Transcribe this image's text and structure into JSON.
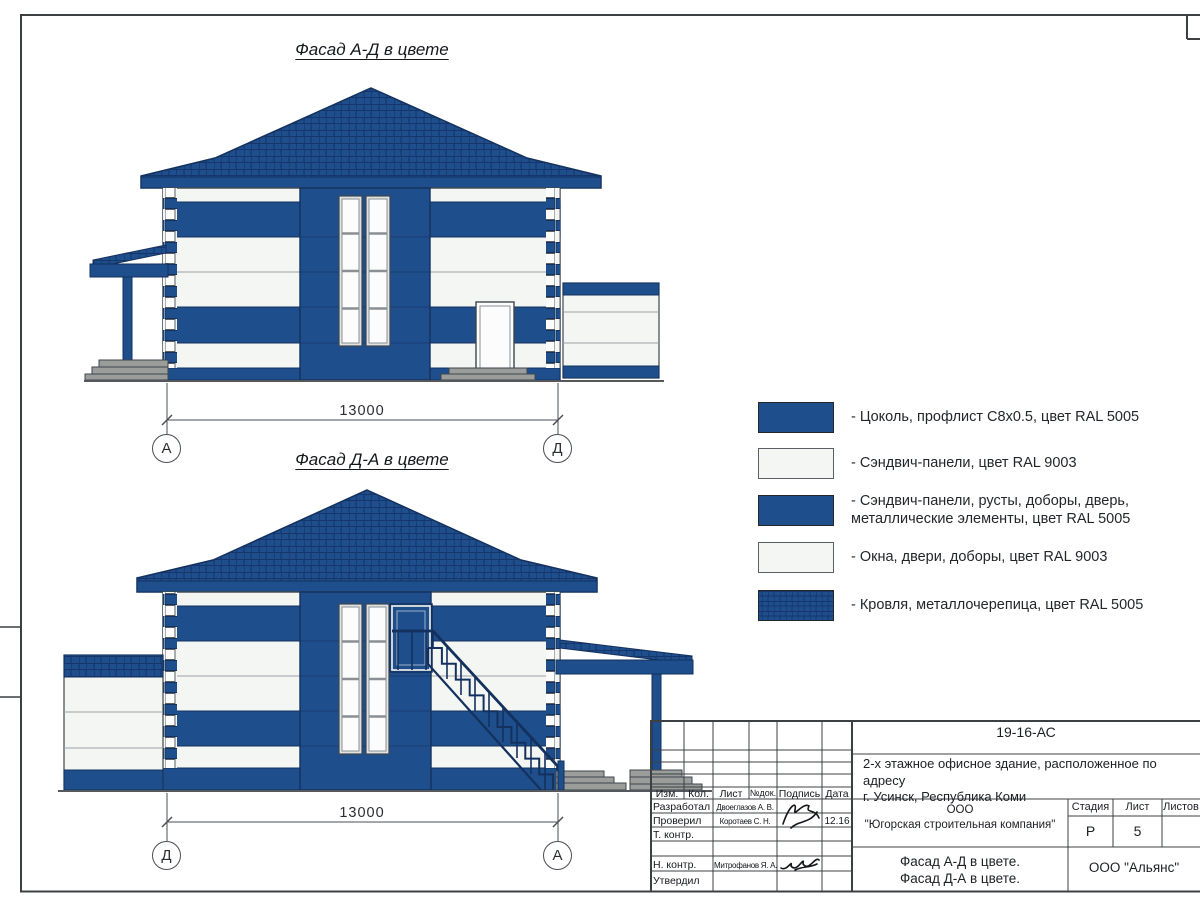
{
  "drawing": {
    "facade1": {
      "title": "Фасад А-Д в цвете",
      "dimension": "13000",
      "axis_left": "А",
      "axis_right": "Д"
    },
    "facade2": {
      "title": "Фасад Д-А в цвете",
      "dimension": "13000",
      "axis_left": "Д",
      "axis_right": "А"
    }
  },
  "legend": {
    "items": [
      {
        "swatch": "blue",
        "label": "- Цоколь, профлист С8х0.5, цвет RAL 5005"
      },
      {
        "swatch": "white",
        "label": "- Сэндвич-панели, цвет RAL 9003"
      },
      {
        "swatch": "blue",
        "label": "- Сэндвич-панели, русты, доборы, дверь,\nметаллические элементы, цвет RAL 5005"
      },
      {
        "swatch": "white",
        "label": "- Окна, двери, доборы, цвет RAL 9003"
      },
      {
        "swatch": "roof",
        "label": "- Кровля, металлочерепица, цвет RAL 5005"
      }
    ]
  },
  "title_block": {
    "doc_number": "19-16-АС",
    "project_title": "2-х этажное офисное здание, расположенное по адресу\nг. Усинск, Республика Коми",
    "columns": {
      "izm": "Изм.",
      "kol": "Кол.",
      "list": "Лист",
      "ndoc": "№док.",
      "sign": "Подпись",
      "date": "Дата"
    },
    "rows": [
      {
        "role": "Разработал",
        "name": "Двоеглазов А. В.",
        "date": ""
      },
      {
        "role": "Проверил",
        "name": "Коротаев С. Н.",
        "date": "12.16"
      },
      {
        "role": "Т. контр.",
        "name": "",
        "date": ""
      },
      {
        "role": "",
        "name": "",
        "date": ""
      },
      {
        "role": "Н. контр.",
        "name": "Митрофанов Я. А.",
        "date": ""
      },
      {
        "role": "Утвердил",
        "name": "",
        "date": ""
      }
    ],
    "company": "ООО\n\"Югорская строительная компания\"",
    "stage_label": "Стадия",
    "sheet_label": "Лист",
    "sheets_label": "Листов",
    "stage_value": "Р",
    "sheet_value": "5",
    "sheets_value": "",
    "drawing_name": "Фасад А-Д в цвете.\nФасад Д-А в цвете.",
    "contractor": "ООО \"Альянс\""
  },
  "colors": {
    "ral5005_blue": "#1E4E8C",
    "ral9003_white": "#F4F6F4",
    "roof_hatch": "#16356B",
    "steps_gray": "#9A9D9A"
  }
}
